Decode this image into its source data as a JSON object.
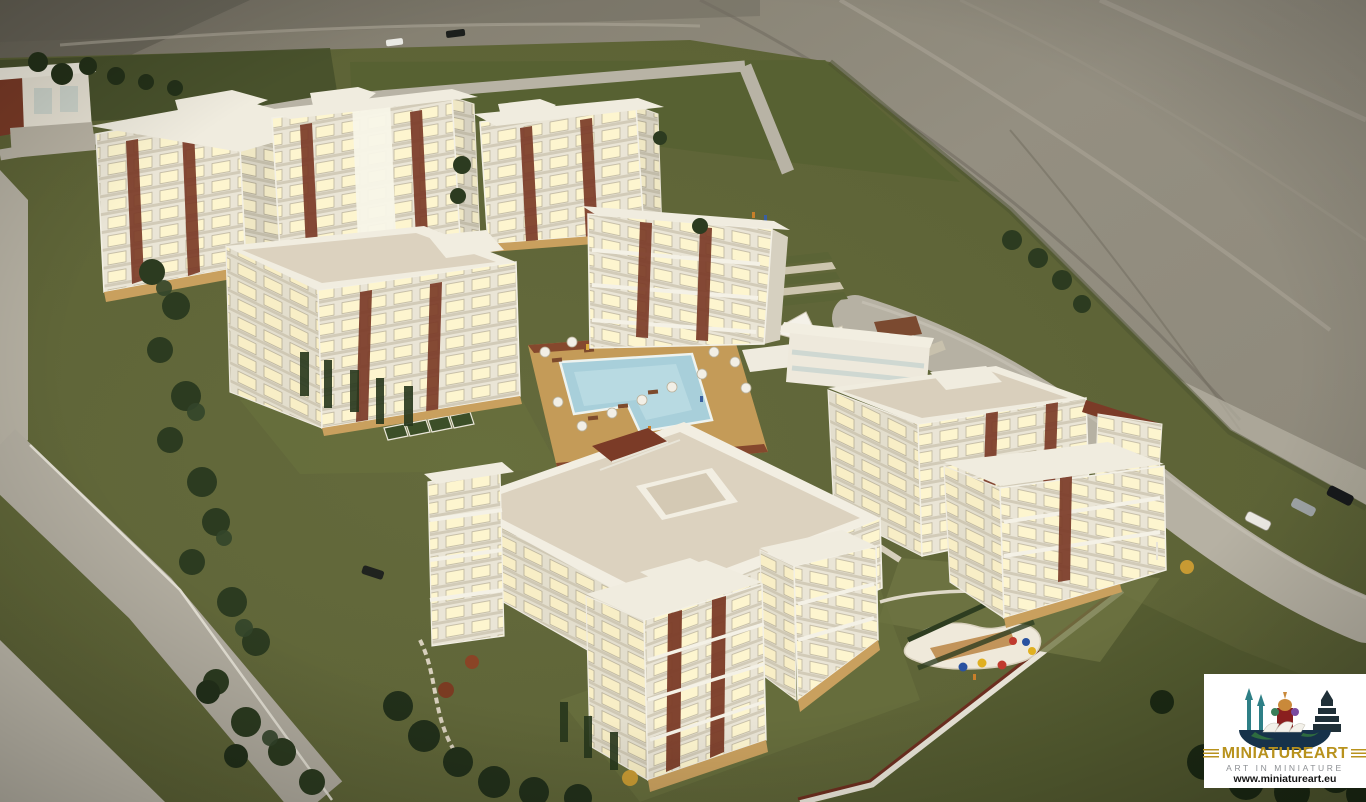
{
  "meta": {
    "title": "Photograph of an illuminated architectural scale model of a residential complex",
    "type": "photograph"
  },
  "watermark": {
    "brand": "MINIATUREART",
    "tagline": "ART IN MINIATURE",
    "url": "www.miniatureart.eu",
    "graphic": "globe-hemisphere with world landmarks (minarets, St Basil's cathedral, pagoda, Sydney Opera House)"
  },
  "scene": {
    "description": "Aerial view of a miniature model: nine white apartment blocks with warm lit windows and maroon accent panels around a central L-shaped swimming pool with umbrellas, sun loungers and shade sails; olive-green terrain board, light grey roads with parked model cars, tree clusters, a playground with coloured balls, all in front of a draped grey fabric backdrop.",
    "elements": [
      "fabric backdrop with folds",
      "green terrain board",
      "apartment blocks with illuminated windows",
      "central swimming pool with wooden deck",
      "pool umbrellas and sun loungers",
      "white shade sails and pavilion",
      "perimeter roads",
      "parked cars",
      "boundary wall with maroon cap",
      "playground with coloured balls",
      "model villa at top left",
      "tree and shrub clusters"
    ],
    "cars": [
      {
        "location": "top road",
        "color": "dark"
      },
      {
        "location": "top road",
        "color": "white"
      },
      {
        "location": "right road",
        "color": "white"
      },
      {
        "location": "right road",
        "color": "silver"
      },
      {
        "location": "right road",
        "color": "black"
      },
      {
        "location": "inner parking",
        "color": "dark"
      }
    ],
    "playground_ball_colors": [
      "blue",
      "yellow",
      "red",
      "red",
      "blue",
      "yellow"
    ],
    "umbrella_count": 15
  },
  "colors": {
    "fabric_backdrop": "#908b7d",
    "terrain_green": "#5d6336",
    "lawn_green": "#6f7544",
    "road_gray": "#b6b1a3",
    "building_white": "#efebdf",
    "window_glow": "#fdf5cf",
    "accent_maroon": "#7b3b27",
    "roof_beige": "#d9cfbc",
    "pool_blue": "#a8cfda",
    "deck_tan": "#c49b58",
    "tree_green": "#2c3b20",
    "logo_gold": "#b8921d"
  }
}
